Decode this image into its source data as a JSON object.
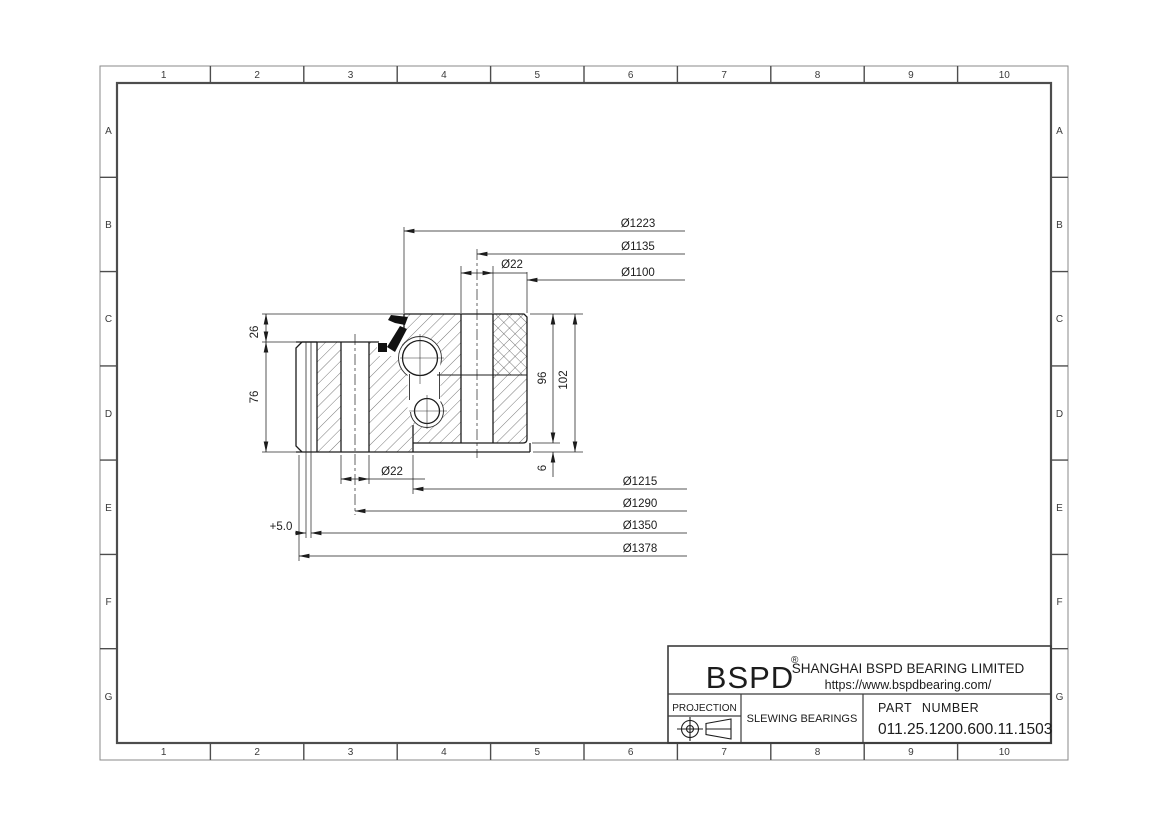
{
  "sheet": {
    "background": "#ffffff",
    "line_color": "#1c1c1c",
    "border_color": "#5f5f5f",
    "hatch_color": "#3f3f3f",
    "seal_color": "#111111"
  },
  "border": {
    "columns": [
      "1",
      "2",
      "3",
      "4",
      "5",
      "6",
      "7",
      "8",
      "9",
      "10"
    ],
    "rows": [
      "A",
      "B",
      "C",
      "D",
      "E",
      "F",
      "G"
    ]
  },
  "dims": {
    "d1223": "Ø1223",
    "d1135": "Ø1135",
    "d22_top": "Ø22",
    "d1100": "Ø1100",
    "d1215": "Ø1215",
    "d1290": "Ø1290",
    "d1350": "Ø1350",
    "d1378": "Ø1378",
    "d22_bottom": "Ø22",
    "offset": "+5.0",
    "h26": "26",
    "h76": "76",
    "h96": "96",
    "h102": "102",
    "h6": "6"
  },
  "title_block": {
    "brand": "BSPD",
    "registered": "®",
    "company": "SHANGHAI BSPD BEARING LIMITED",
    "url": "https://www.bspdbearing.com/",
    "projection_label": "PROJECTION",
    "product_type": "SLEWING BEARINGS",
    "part_number_label": "PART  NUMBER",
    "part_number": "011.25.1200.600.11.1503"
  }
}
